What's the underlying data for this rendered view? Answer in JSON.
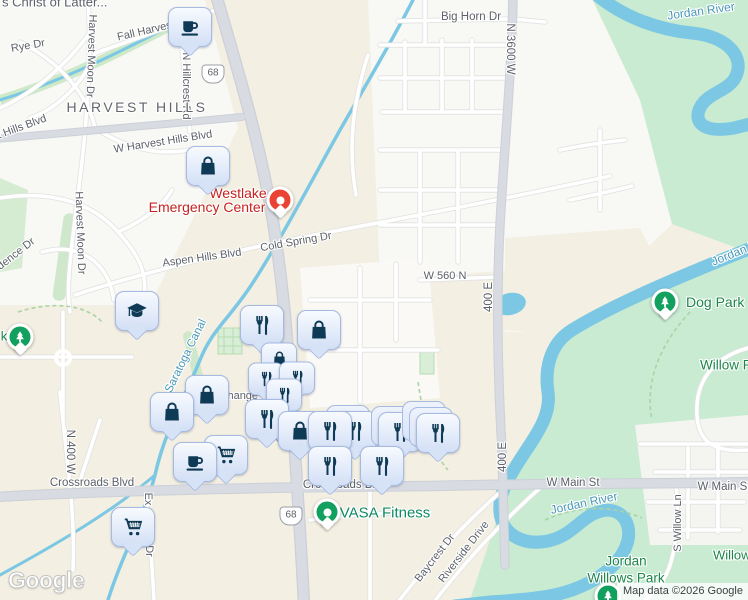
{
  "map": {
    "attribution": "Map data ©2026 Google",
    "logo_text": "Google",
    "colors": {
      "land_beige": "#f3efe2",
      "land_white": "#f8f8f5",
      "park_green": "#c8ebd2",
      "water": "#7cc8e4",
      "road_major": "#d6d9df",
      "road_minor": "#ffffff",
      "marker_icon": "#0e3a55",
      "marker_border": "#a6b9e0",
      "label_road": "#5c6068",
      "label_water": "#4a98b8",
      "label_park": "#1d8549",
      "label_emergency": "#c5221f",
      "label_fitness": "#0d8a62",
      "pin_green": "#12a05f",
      "pin_red": "#e94335"
    },
    "labels": [
      {
        "text": "s Christ of Latter...",
        "x": 2,
        "y": 2,
        "cls": "",
        "size": 13,
        "anchor": "left"
      },
      {
        "text": "Big Horn Dr",
        "x": 471,
        "y": 17,
        "size": 11.5
      },
      {
        "text": "N 3600 W",
        "x": 510,
        "y": 49,
        "rot": 90,
        "size": 11.5
      },
      {
        "text": "Jordan River",
        "x": 701,
        "y": 11,
        "rot": -8,
        "cls": "water",
        "size": 12
      },
      {
        "text": "Fall Harvest",
        "x": 146,
        "y": 31,
        "rot": -13
      },
      {
        "text": "Rye Dr",
        "x": 28,
        "y": 46,
        "rot": -10
      },
      {
        "text": "Harvest Moon Dr",
        "x": 91,
        "y": 56,
        "rot": 92
      },
      {
        "text": "Harvest Moon Dr",
        "x": 80,
        "y": 233,
        "rot": 88
      },
      {
        "text": "N Hillcrest Rd",
        "x": 186,
        "y": 86,
        "rot": 90
      },
      {
        "text": "HARVEST HILLS",
        "x": 137,
        "y": 107,
        "cls": "city",
        "size": 14
      },
      {
        "text": "W Harvest Hills Blvd",
        "x": 163,
        "y": 142,
        "rot": -9
      },
      {
        "text": "t Hills Blvd",
        "x": 22,
        "y": 127,
        "rot": -20
      },
      {
        "text": "dence Dr",
        "x": 16,
        "y": 254,
        "rot": -38
      },
      {
        "text": "Aspen Hills Blvd",
        "x": 202,
        "y": 258,
        "rot": -8
      },
      {
        "text": "Cold Spring Dr",
        "x": 296,
        "y": 242,
        "rot": -10
      },
      {
        "text": "W 560 N",
        "x": 445,
        "y": 276
      },
      {
        "text": "400 E",
        "x": 489,
        "y": 297,
        "rot": -90,
        "size": 11.5
      },
      {
        "text": "400 E",
        "x": 503,
        "y": 457,
        "rot": -90,
        "size": 11.5
      },
      {
        "text": "Saratoga Canal",
        "x": 186,
        "y": 356,
        "rot": -64,
        "cls": "water",
        "size": 11.5
      },
      {
        "text": "change",
        "x": 240,
        "y": 396
      },
      {
        "text": "Dog Park a",
        "x": 686,
        "y": 302,
        "cls": "park",
        "size": 14,
        "anchor": "left"
      },
      {
        "text": "Willow P",
        "x": 700,
        "y": 365,
        "cls": "park",
        "size": 13.5,
        "anchor": "left"
      },
      {
        "text": "Jordan Riv",
        "x": 712,
        "y": 262,
        "rot": -22,
        "cls": "water",
        "size": 12,
        "anchor": "left"
      },
      {
        "text": "N 400 W",
        "x": 70,
        "y": 452,
        "rot": 90,
        "size": 11.5
      },
      {
        "text": "Crossroads Blvd",
        "x": 92,
        "y": 483,
        "size": 11.5
      },
      {
        "text": "Crossroads Blvd",
        "x": 345,
        "y": 485,
        "size": 11.5
      },
      {
        "text": "Ex",
        "x": 148,
        "y": 499,
        "rot": 90
      },
      {
        "text": "Dr",
        "x": 149,
        "y": 551,
        "rot": 90
      },
      {
        "text": "W Main St",
        "x": 573,
        "y": 483,
        "size": 11.5
      },
      {
        "text": "W Main St",
        "x": 724,
        "y": 487,
        "size": 11.5
      },
      {
        "text": "Jordan River",
        "x": 584,
        "y": 503,
        "rot": -12,
        "cls": "water",
        "size": 12
      },
      {
        "text": "S Willow Ln",
        "x": 678,
        "y": 523,
        "rot": -90
      },
      {
        "text": "Willow",
        "x": 713,
        "y": 555,
        "cls": "park",
        "size": 13,
        "anchor": "left"
      },
      {
        "text": "Jordan",
        "x": 626,
        "y": 561,
        "cls": "park",
        "size": 13.5
      },
      {
        "text": "Willows Park",
        "x": 626,
        "y": 578,
        "cls": "park",
        "size": 13.5
      },
      {
        "text": "VASA Fitness",
        "x": 385,
        "y": 513,
        "cls": "poigreen",
        "size": 15
      },
      {
        "text": "Westlake",
        "x": 238,
        "y": 193,
        "cls": "poired",
        "size": 14
      },
      {
        "text": "Emergency Center",
        "x": 207,
        "y": 207,
        "cls": "poired",
        "size": 14
      },
      {
        "text": "k",
        "x": 4,
        "y": 336,
        "cls": "park",
        "size": 13
      },
      {
        "text": "Baycrest Dr",
        "x": 435,
        "y": 558,
        "rot": -52
      },
      {
        "text": "Riverside Drive",
        "x": 464,
        "y": 552,
        "rot": -52
      }
    ],
    "shields": [
      {
        "text": "68",
        "x": 213,
        "y": 74
      },
      {
        "text": "68",
        "x": 286,
        "y": 435
      },
      {
        "text": "68",
        "x": 291,
        "y": 516
      }
    ],
    "markers": [
      {
        "icon": "coffee",
        "x": 190,
        "y": 27
      },
      {
        "icon": "bag",
        "x": 208,
        "y": 166
      },
      {
        "icon": "grad",
        "x": 137,
        "y": 311
      },
      {
        "icon": "fork",
        "x": 262,
        "y": 325
      },
      {
        "icon": "bag",
        "x": 319,
        "y": 330
      },
      {
        "icon": "bag",
        "x": 279,
        "y": 359,
        "size": "sm"
      },
      {
        "icon": "fork",
        "x": 266,
        "y": 379,
        "size": "sm"
      },
      {
        "icon": "fork",
        "x": 297,
        "y": 378,
        "size": "sm"
      },
      {
        "icon": "fork",
        "x": 284,
        "y": 395,
        "size": "sm"
      },
      {
        "icon": "bag",
        "x": 207,
        "y": 395
      },
      {
        "icon": "bag",
        "x": 172,
        "y": 412
      },
      {
        "icon": "fork",
        "x": 267,
        "y": 419
      },
      {
        "icon": "fork",
        "x": 355,
        "y": 431,
        "backs": 1
      },
      {
        "icon": "bag",
        "x": 300,
        "y": 431
      },
      {
        "icon": "fork",
        "x": 330,
        "y": 431
      },
      {
        "icon": "fork",
        "x": 400,
        "y": 432,
        "backs": 1
      },
      {
        "icon": "fork",
        "x": 438,
        "y": 433,
        "backs": 2
      },
      {
        "icon": "fork",
        "x": 330,
        "y": 466
      },
      {
        "icon": "fork",
        "x": 382,
        "y": 466
      },
      {
        "icon": "cart",
        "x": 226,
        "y": 455
      },
      {
        "icon": "coffee",
        "x": 195,
        "y": 462
      },
      {
        "icon": "cart",
        "x": 133,
        "y": 527
      }
    ],
    "pins": [
      {
        "kind": "tree",
        "x": 20,
        "y": 337
      },
      {
        "kind": "tree",
        "x": 665,
        "y": 302
      },
      {
        "kind": "tree",
        "x": 608,
        "y": 596
      },
      {
        "kind": "med",
        "x": 280,
        "y": 200
      },
      {
        "kind": "dot",
        "x": 327,
        "y": 512
      }
    ]
  }
}
